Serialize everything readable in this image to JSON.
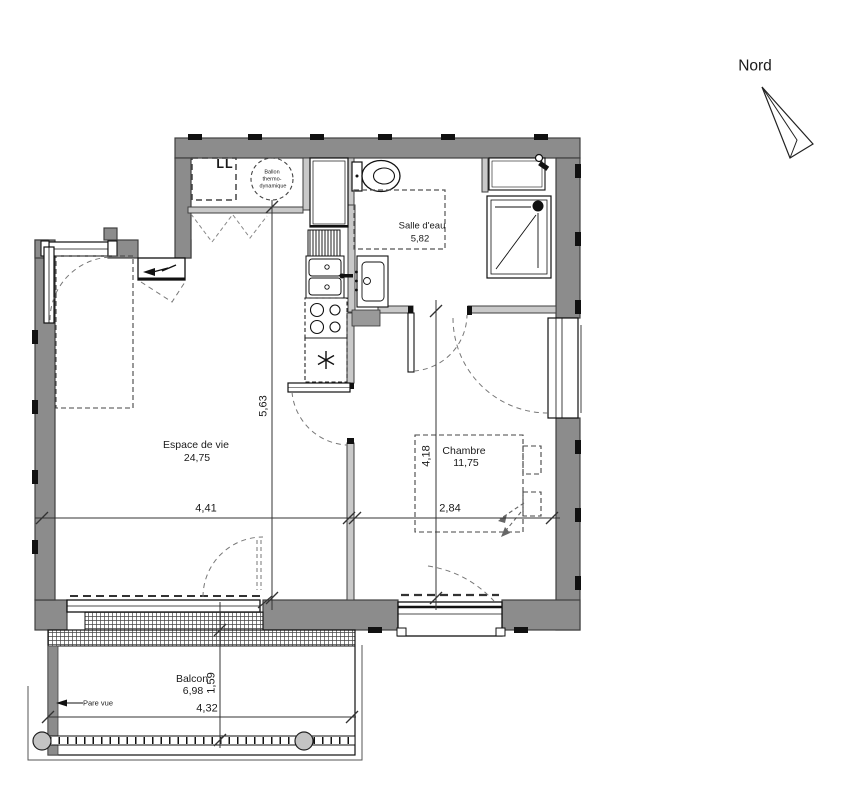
{
  "north_label": "Nord",
  "rooms": {
    "salle_deau": {
      "name": "Salle d'eau",
      "area": "5,82"
    },
    "espace_de_vie": {
      "name": "Espace de vie",
      "area": "24,75"
    },
    "chambre": {
      "name": "Chambre",
      "area": "11,75"
    },
    "balcon": {
      "name": "Balcon",
      "area": "6,98"
    }
  },
  "dimensions": {
    "living_width": "4,41",
    "living_height": "5,63",
    "chambre_width": "2,84",
    "chambre_height": "4,18",
    "balcon_width": "4,32",
    "balcon_depth": "1,59"
  },
  "annotations": {
    "washing_machine": "LL",
    "water_heater_line1": "Ballon",
    "water_heater_line2": "thermo-",
    "water_heater_line3": "dynamique",
    "privacy_screen": "Pare vue"
  },
  "colors": {
    "wall": "#8c8c8c",
    "partition": "#c9c9c9",
    "line": "#1a1a1a"
  }
}
